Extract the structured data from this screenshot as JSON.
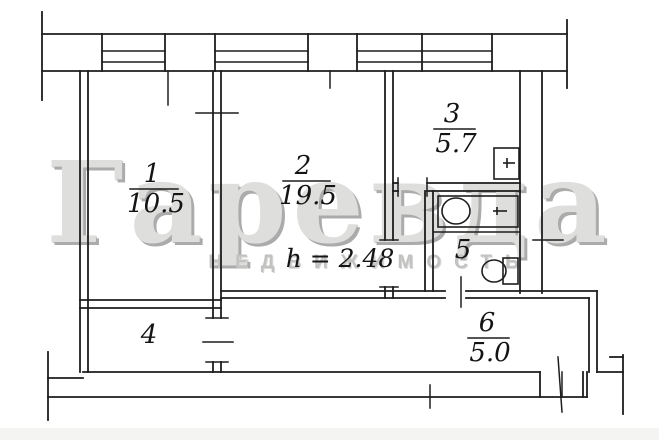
{
  "plan": {
    "height_note": "h = 2.48",
    "rooms": [
      {
        "number": "1",
        "area": "10.5"
      },
      {
        "number": "2",
        "area": "19.5"
      },
      {
        "number": "3",
        "area": "5.7"
      },
      {
        "number": "4",
        "area": ""
      },
      {
        "number": "5",
        "area": ""
      },
      {
        "number": "6",
        "area": "5.0"
      }
    ],
    "fixtures": [
      "bathtub-icon",
      "toilet-icon",
      "sink-icon"
    ],
    "colors": {
      "line": "#1d1d1d",
      "background": "#ffffff",
      "watermark": "#dededd",
      "watermark_shadow": "#ababab",
      "watermark_subtitle": "#c2c2c1"
    }
  },
  "watermark": {
    "title": "Гаревда",
    "subtitle": "НЕДВИЖИМОСТЬ"
  }
}
